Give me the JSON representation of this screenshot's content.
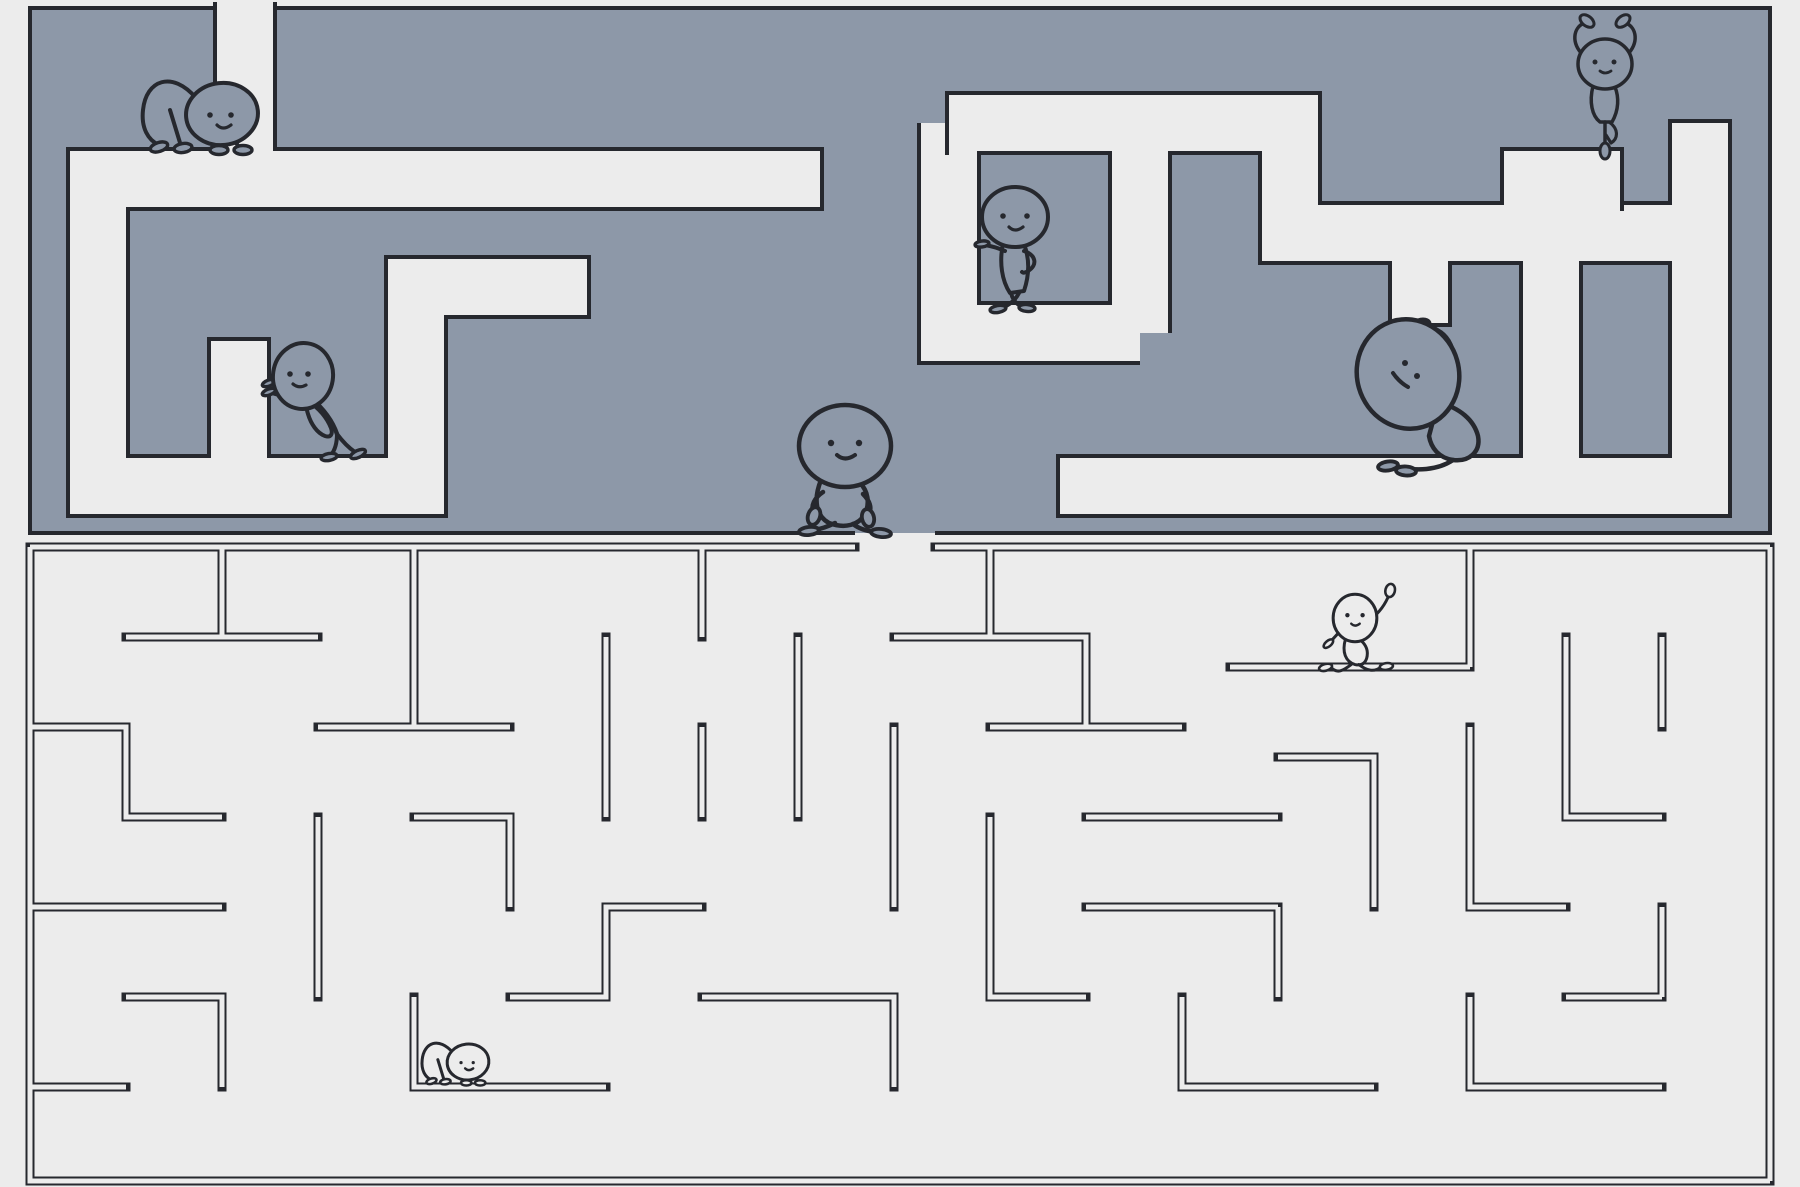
{
  "scene": {
    "width": 1800,
    "height": 1187
  },
  "colors": {
    "background": "#ececec",
    "maze_wall_fill": "#8d98a8",
    "corridor_light": "#ececec",
    "line_dark": "#26282e",
    "figure_stroke": "#26282e"
  },
  "top_maze": {
    "slab": {
      "x": 30,
      "y": 8,
      "w": 1740,
      "h": 525
    },
    "corridor_width": 56,
    "outline_width": 4,
    "entrance_gap_top": {
      "x1": 217,
      "x2": 273
    },
    "exit_gap_bottom": {
      "x1": 855,
      "x2": 935
    },
    "corridors": [
      {
        "points": [
          [
            245,
            2
          ],
          [
            245,
            179
          ]
        ],
        "caps": []
      },
      {
        "points": [
          [
            820,
            179
          ],
          [
            98,
            179
          ],
          [
            98,
            486
          ],
          [
            416,
            486
          ],
          [
            416,
            287
          ],
          [
            587,
            287
          ]
        ],
        "caps": [
          0,
          1
        ]
      },
      {
        "points": [
          [
            239,
            486
          ],
          [
            239,
            341
          ]
        ],
        "caps": [
          1
        ]
      },
      {
        "points": [
          [
            949,
            123
          ],
          [
            1290,
            123
          ],
          [
            1290,
            233
          ],
          [
            1700,
            233
          ]
        ],
        "caps": [
          0
        ]
      },
      {
        "points": [
          [
            949,
            123
          ],
          [
            949,
            333
          ],
          [
            1140,
            333
          ]
        ],
        "caps": []
      },
      {
        "points": [
          [
            1140,
            333
          ],
          [
            1140,
            123
          ]
        ],
        "caps": []
      },
      {
        "points": [
          [
            1532,
            233
          ],
          [
            1532,
            179
          ],
          [
            1620,
            179
          ]
        ],
        "caps": [
          1
        ]
      },
      {
        "points": [
          [
            1700,
            123
          ],
          [
            1700,
            486
          ],
          [
            1060,
            486
          ]
        ],
        "caps": [
          0,
          1
        ]
      },
      {
        "points": [
          [
            1420,
            233
          ],
          [
            1420,
            323
          ]
        ],
        "caps": [
          1
        ]
      },
      {
        "points": [
          [
            1551,
            261
          ],
          [
            1551,
            486
          ]
        ],
        "caps": []
      }
    ]
  },
  "bottom_maze": {
    "bounds": {
      "x1": 30,
      "y1": 547,
      "x2": 1770,
      "y2": 1181
    },
    "wall_outer_width": 9,
    "wall_inner_width": 5,
    "entrance_gap_top": {
      "x1": 855,
      "x2": 935
    },
    "walls": [
      {
        "points": [
          [
            30,
            547
          ],
          [
            855,
            547
          ]
        ]
      },
      {
        "points": [
          [
            935,
            547
          ],
          [
            1770,
            547
          ]
        ]
      },
      {
        "points": [
          [
            1770,
            547
          ],
          [
            1770,
            1181
          ]
        ]
      },
      {
        "points": [
          [
            1770,
            1181
          ],
          [
            30,
            1181
          ],
          [
            30,
            547
          ]
        ]
      },
      {
        "points": [
          [
            126,
            637
          ],
          [
            318,
            637
          ]
        ]
      },
      {
        "points": [
          [
            414,
            547
          ],
          [
            414,
            727
          ]
        ]
      },
      {
        "points": [
          [
            30,
            727
          ],
          [
            126,
            727
          ],
          [
            126,
            817
          ],
          [
            222,
            817
          ]
        ]
      },
      {
        "points": [
          [
            318,
            727
          ],
          [
            510,
            727
          ]
        ]
      },
      {
        "points": [
          [
            30,
            907
          ],
          [
            222,
            907
          ]
        ]
      },
      {
        "points": [
          [
            318,
            817
          ],
          [
            318,
            997
          ]
        ]
      },
      {
        "points": [
          [
            414,
            817
          ],
          [
            510,
            817
          ],
          [
            510,
            907
          ]
        ]
      },
      {
        "points": [
          [
            126,
            997
          ],
          [
            222,
            997
          ],
          [
            222,
            1087
          ]
        ]
      },
      {
        "points": [
          [
            414,
            997
          ],
          [
            414,
            1087
          ],
          [
            606,
            1087
          ]
        ]
      },
      {
        "points": [
          [
            510,
            997
          ],
          [
            606,
            997
          ],
          [
            606,
            907
          ],
          [
            702,
            907
          ]
        ]
      },
      {
        "points": [
          [
            606,
            637
          ],
          [
            606,
            817
          ]
        ]
      },
      {
        "points": [
          [
            702,
            547
          ],
          [
            702,
            637
          ]
        ]
      },
      {
        "points": [
          [
            798,
            637
          ],
          [
            798,
            817
          ]
        ]
      },
      {
        "points": [
          [
            702,
            727
          ],
          [
            702,
            817
          ]
        ]
      },
      {
        "points": [
          [
            894,
            637
          ],
          [
            1086,
            637
          ],
          [
            1086,
            727
          ]
        ]
      },
      {
        "points": [
          [
            894,
            727
          ],
          [
            894,
            907
          ]
        ]
      },
      {
        "points": [
          [
            990,
            727
          ],
          [
            1182,
            727
          ]
        ]
      },
      {
        "points": [
          [
            990,
            817
          ],
          [
            990,
            997
          ],
          [
            1086,
            997
          ]
        ]
      },
      {
        "points": [
          [
            1086,
            817
          ],
          [
            1278,
            817
          ]
        ]
      },
      {
        "points": [
          [
            702,
            997
          ],
          [
            894,
            997
          ],
          [
            894,
            1087
          ]
        ]
      },
      {
        "points": [
          [
            1230,
            667
          ],
          [
            1470,
            667
          ]
        ]
      },
      {
        "points": [
          [
            1470,
            547
          ],
          [
            1470,
            667
          ]
        ]
      },
      {
        "points": [
          [
            1566,
            637
          ],
          [
            1566,
            817
          ],
          [
            1662,
            817
          ]
        ]
      },
      {
        "points": [
          [
            1278,
            757
          ],
          [
            1374,
            757
          ],
          [
            1374,
            907
          ]
        ]
      },
      {
        "points": [
          [
            1470,
            727
          ],
          [
            1470,
            907
          ],
          [
            1566,
            907
          ]
        ]
      },
      {
        "points": [
          [
            1662,
            637
          ],
          [
            1662,
            727
          ]
        ]
      },
      {
        "points": [
          [
            1086,
            907
          ],
          [
            1278,
            907
          ]
        ]
      },
      {
        "points": [
          [
            1182,
            997
          ],
          [
            1182,
            1087
          ],
          [
            1374,
            1087
          ]
        ]
      },
      {
        "points": [
          [
            1470,
            997
          ],
          [
            1470,
            1087
          ],
          [
            1662,
            1087
          ]
        ]
      },
      {
        "points": [
          [
            1566,
            997
          ],
          [
            1662,
            997
          ]
        ]
      },
      {
        "points": [
          [
            222,
            547
          ],
          [
            222,
            637
          ]
        ]
      },
      {
        "points": [
          [
            990,
            547
          ],
          [
            990,
            637
          ]
        ]
      },
      {
        "points": [
          [
            1278,
            907
          ],
          [
            1278,
            997
          ]
        ]
      },
      {
        "points": [
          [
            1662,
            907
          ],
          [
            1662,
            997
          ]
        ]
      },
      {
        "points": [
          [
            30,
            1087
          ],
          [
            126,
            1087
          ]
        ]
      }
    ]
  },
  "figures": [
    {
      "name": "cat-pose-figure",
      "pose": "cat",
      "x": 222,
      "y": 114,
      "scale": 1.0,
      "fill": "wall",
      "stroke": 4
    },
    {
      "name": "wall-push-figure",
      "pose": "push",
      "x": 303,
      "y": 376,
      "scale": 1.0,
      "fill": "wall",
      "stroke": 4
    },
    {
      "name": "hands-on-hips-figure",
      "pose": "akimbo",
      "x": 1015,
      "y": 217,
      "scale": 1.0,
      "fill": "wall",
      "stroke": 4
    },
    {
      "name": "walking-figure",
      "pose": "walk",
      "x": 845,
      "y": 446,
      "scale": 1.0,
      "fill": "wall",
      "stroke": 4.5
    },
    {
      "name": "side-bend-figure",
      "pose": "bigbend",
      "x": 1408,
      "y": 374,
      "scale": 1.0,
      "fill": "wall",
      "stroke": 4.5
    },
    {
      "name": "tree-pose-figure",
      "pose": "tree",
      "x": 1605,
      "y": 64,
      "scale": 1.0,
      "fill": "wall",
      "stroke": 3.5
    },
    {
      "name": "lunge-wave-figure",
      "pose": "runner",
      "x": 1355,
      "y": 618,
      "scale": 0.95,
      "fill": "bg",
      "stroke": 3
    },
    {
      "name": "small-cat-figure",
      "pose": "cat",
      "x": 468,
      "y": 1062,
      "scale": 0.58,
      "fill": "bg",
      "stroke": 3
    }
  ]
}
